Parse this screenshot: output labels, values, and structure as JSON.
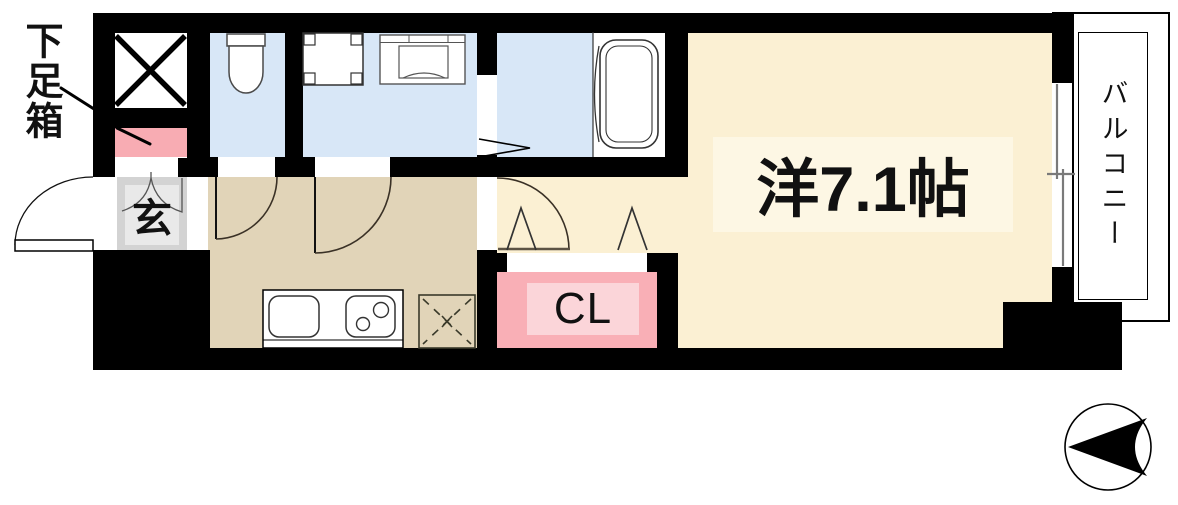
{
  "floor_plan": {
    "labels": {
      "shoe_box": "下足箱",
      "entrance": "玄",
      "closet": "CL",
      "main_room": "洋7.1帖",
      "balcony": "バルコニー"
    },
    "colors": {
      "wall": "#000000",
      "wet_area_floor": "#D8E7F7",
      "kitchen_floor": "#E1D4B8",
      "main_room_floor": "#FBF0D3",
      "main_room_label_bg": "#FDF7E4",
      "closet": "#F9AFB6",
      "closet_inner": "#FBD5D9",
      "shoe_box": "#F8ACB3",
      "entrance_floor": "#D3D3D3",
      "entrance_floor_inner": "#E9E9E9"
    },
    "fixtures": {
      "shaft": "elevator-shaft-x",
      "toilet": "toilet",
      "washer": "washing-machine-pan",
      "vanity": "vanity-sink",
      "bath": "bathtub",
      "sink": "kitchen-sink",
      "stove": "gas-stove",
      "fridge": "refrigerator-space",
      "window": "sliding-window",
      "compass": "compass-north-arrow"
    }
  }
}
